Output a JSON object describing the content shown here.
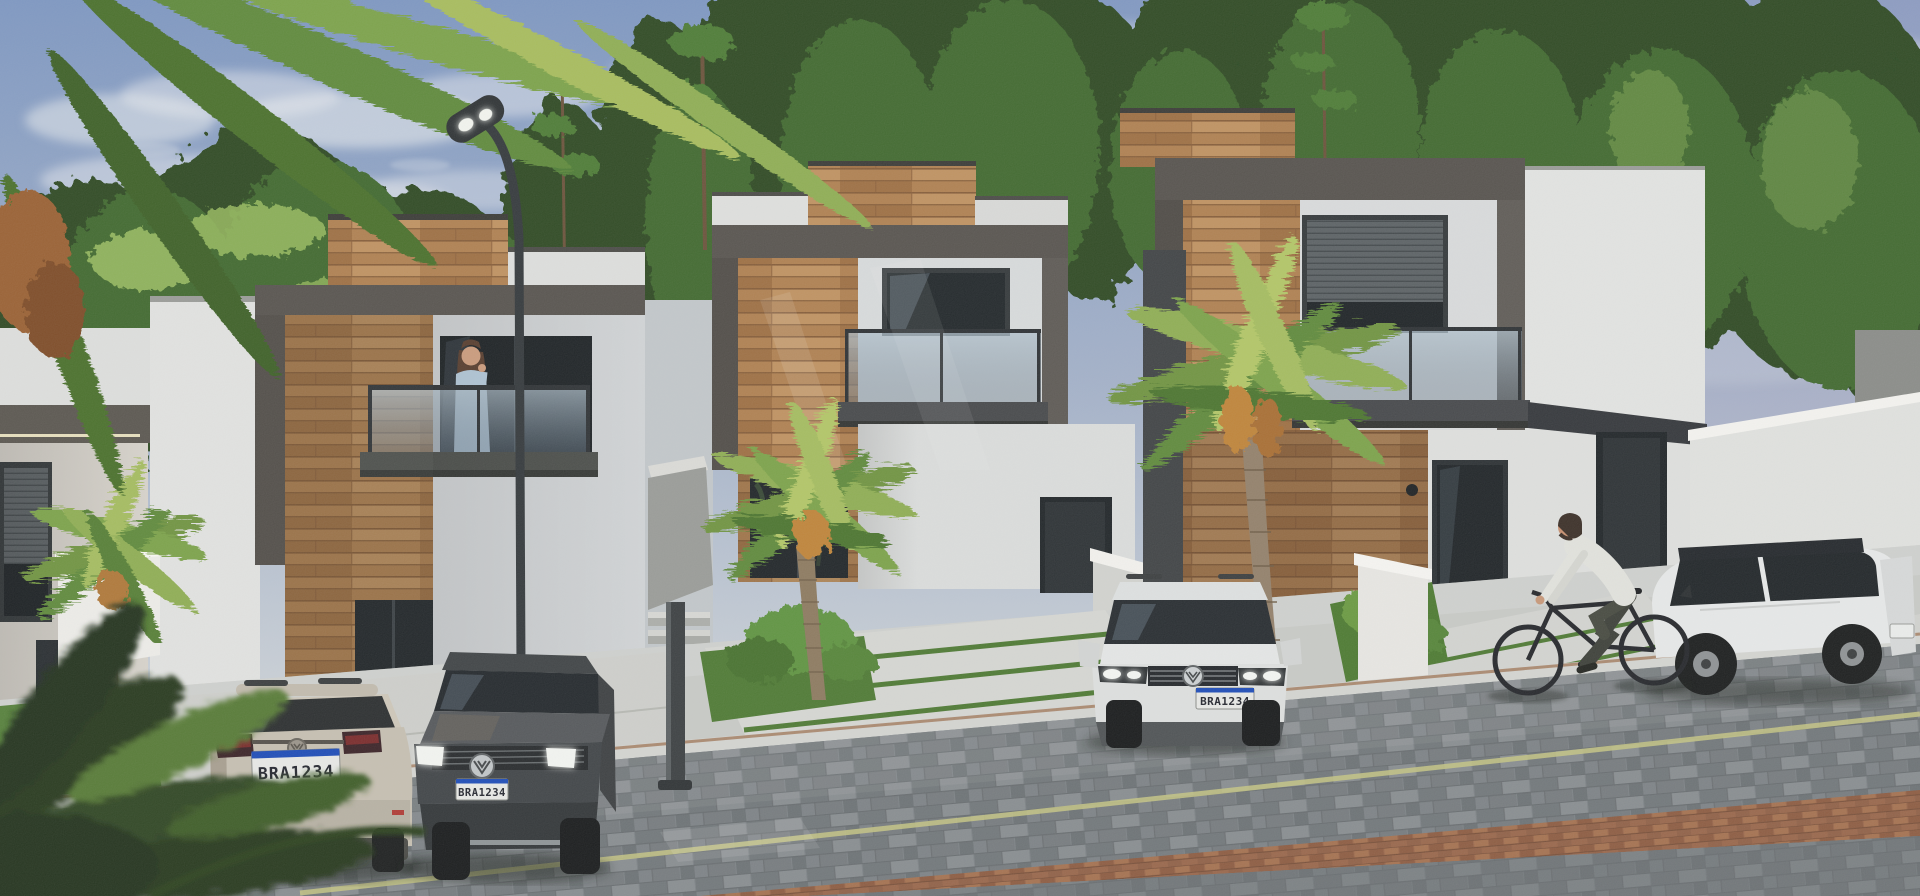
{
  "scene": {
    "type": "architectural-render",
    "time_of_day": "late-afternoon",
    "objects": [
      "modern two-story houses with wood and concrete facades",
      "glass balconies with led cove lighting",
      "palm trees and pine forest backdrop",
      "curved street lamp",
      "parked volkswagen suvs",
      "woman on balcony talking on phone",
      "man riding bicycle",
      "sloped paver street with yellow edge line",
      "concrete driveways with grass joints"
    ]
  },
  "vehicles": {
    "beige_suv": {
      "plate": "BRA1234"
    },
    "dark_suv": {
      "plate": "BRA1234"
    },
    "white_suv_center": {
      "plate": "BRA1234"
    }
  },
  "palette": {
    "sky_top": "#7d97c2",
    "sky_horizon": "#c9d0d8",
    "cloud": "#e9ecef",
    "foliage_dark": "#2d4a24",
    "foliage_mid": "#4d7c36",
    "foliage_light": "#9cc060",
    "concrete_frame": "#57534e",
    "stucco_white": "#e6e7e5",
    "stucco_shade": "#c9ccd0",
    "wood_light": "#c09467",
    "wood_mid": "#a87848",
    "wood_dark": "#8a5f3a",
    "led_warm": "#f7f0ca",
    "glass_dark": "#22272b",
    "balcony_glass": "#8fa2b0",
    "street_paver": "#7e8487",
    "curb": "#d5d6d2",
    "lane_yellow": "#c6c684",
    "brick_strip": "#99664a",
    "sidewalk": "#c9cbc7",
    "grass": "#4e7a33",
    "car_beige": "#c7c0b2",
    "car_dark": "#45484a",
    "car_white": "#e8eaea",
    "plate_bg": "#e9eae7",
    "plate_band": "#1c4bb8",
    "taillight_red": "#c23434",
    "skin": "#d8a584",
    "shirt_blue": "#b9cfe0"
  }
}
